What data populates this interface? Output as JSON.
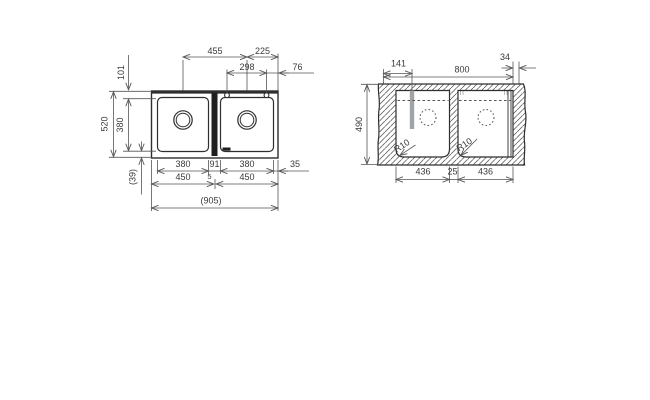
{
  "plan": {
    "top_row1": {
      "left": "455",
      "right": "225"
    },
    "top_row2": {
      "left": "298",
      "right": "76"
    },
    "side": {
      "hole_offset": "101",
      "outer_depth": "520",
      "bowl_depth": "380",
      "rim": "(39)"
    },
    "bottom_row1": {
      "a": "380",
      "b": "91",
      "c": "380",
      "d": "35"
    },
    "bottom_row2": {
      "a": "450",
      "b": "5",
      "c": "450"
    },
    "bottom_row3": {
      "overall": "(905)"
    }
  },
  "section": {
    "top": {
      "a": "141",
      "b": "800",
      "c": "34"
    },
    "side": {
      "depth": "490"
    },
    "bottom": {
      "a": "436",
      "b": "25",
      "c": "436"
    },
    "radii": {
      "left": "R10",
      "right": "R10"
    }
  },
  "colors": {
    "object_line": "#2e2e2e",
    "dim_line": "#555555",
    "text": "#3a3a3a",
    "drain_bar": "#a0a4a6",
    "divider_fill": "#1f1f1f",
    "background": "#ffffff"
  }
}
